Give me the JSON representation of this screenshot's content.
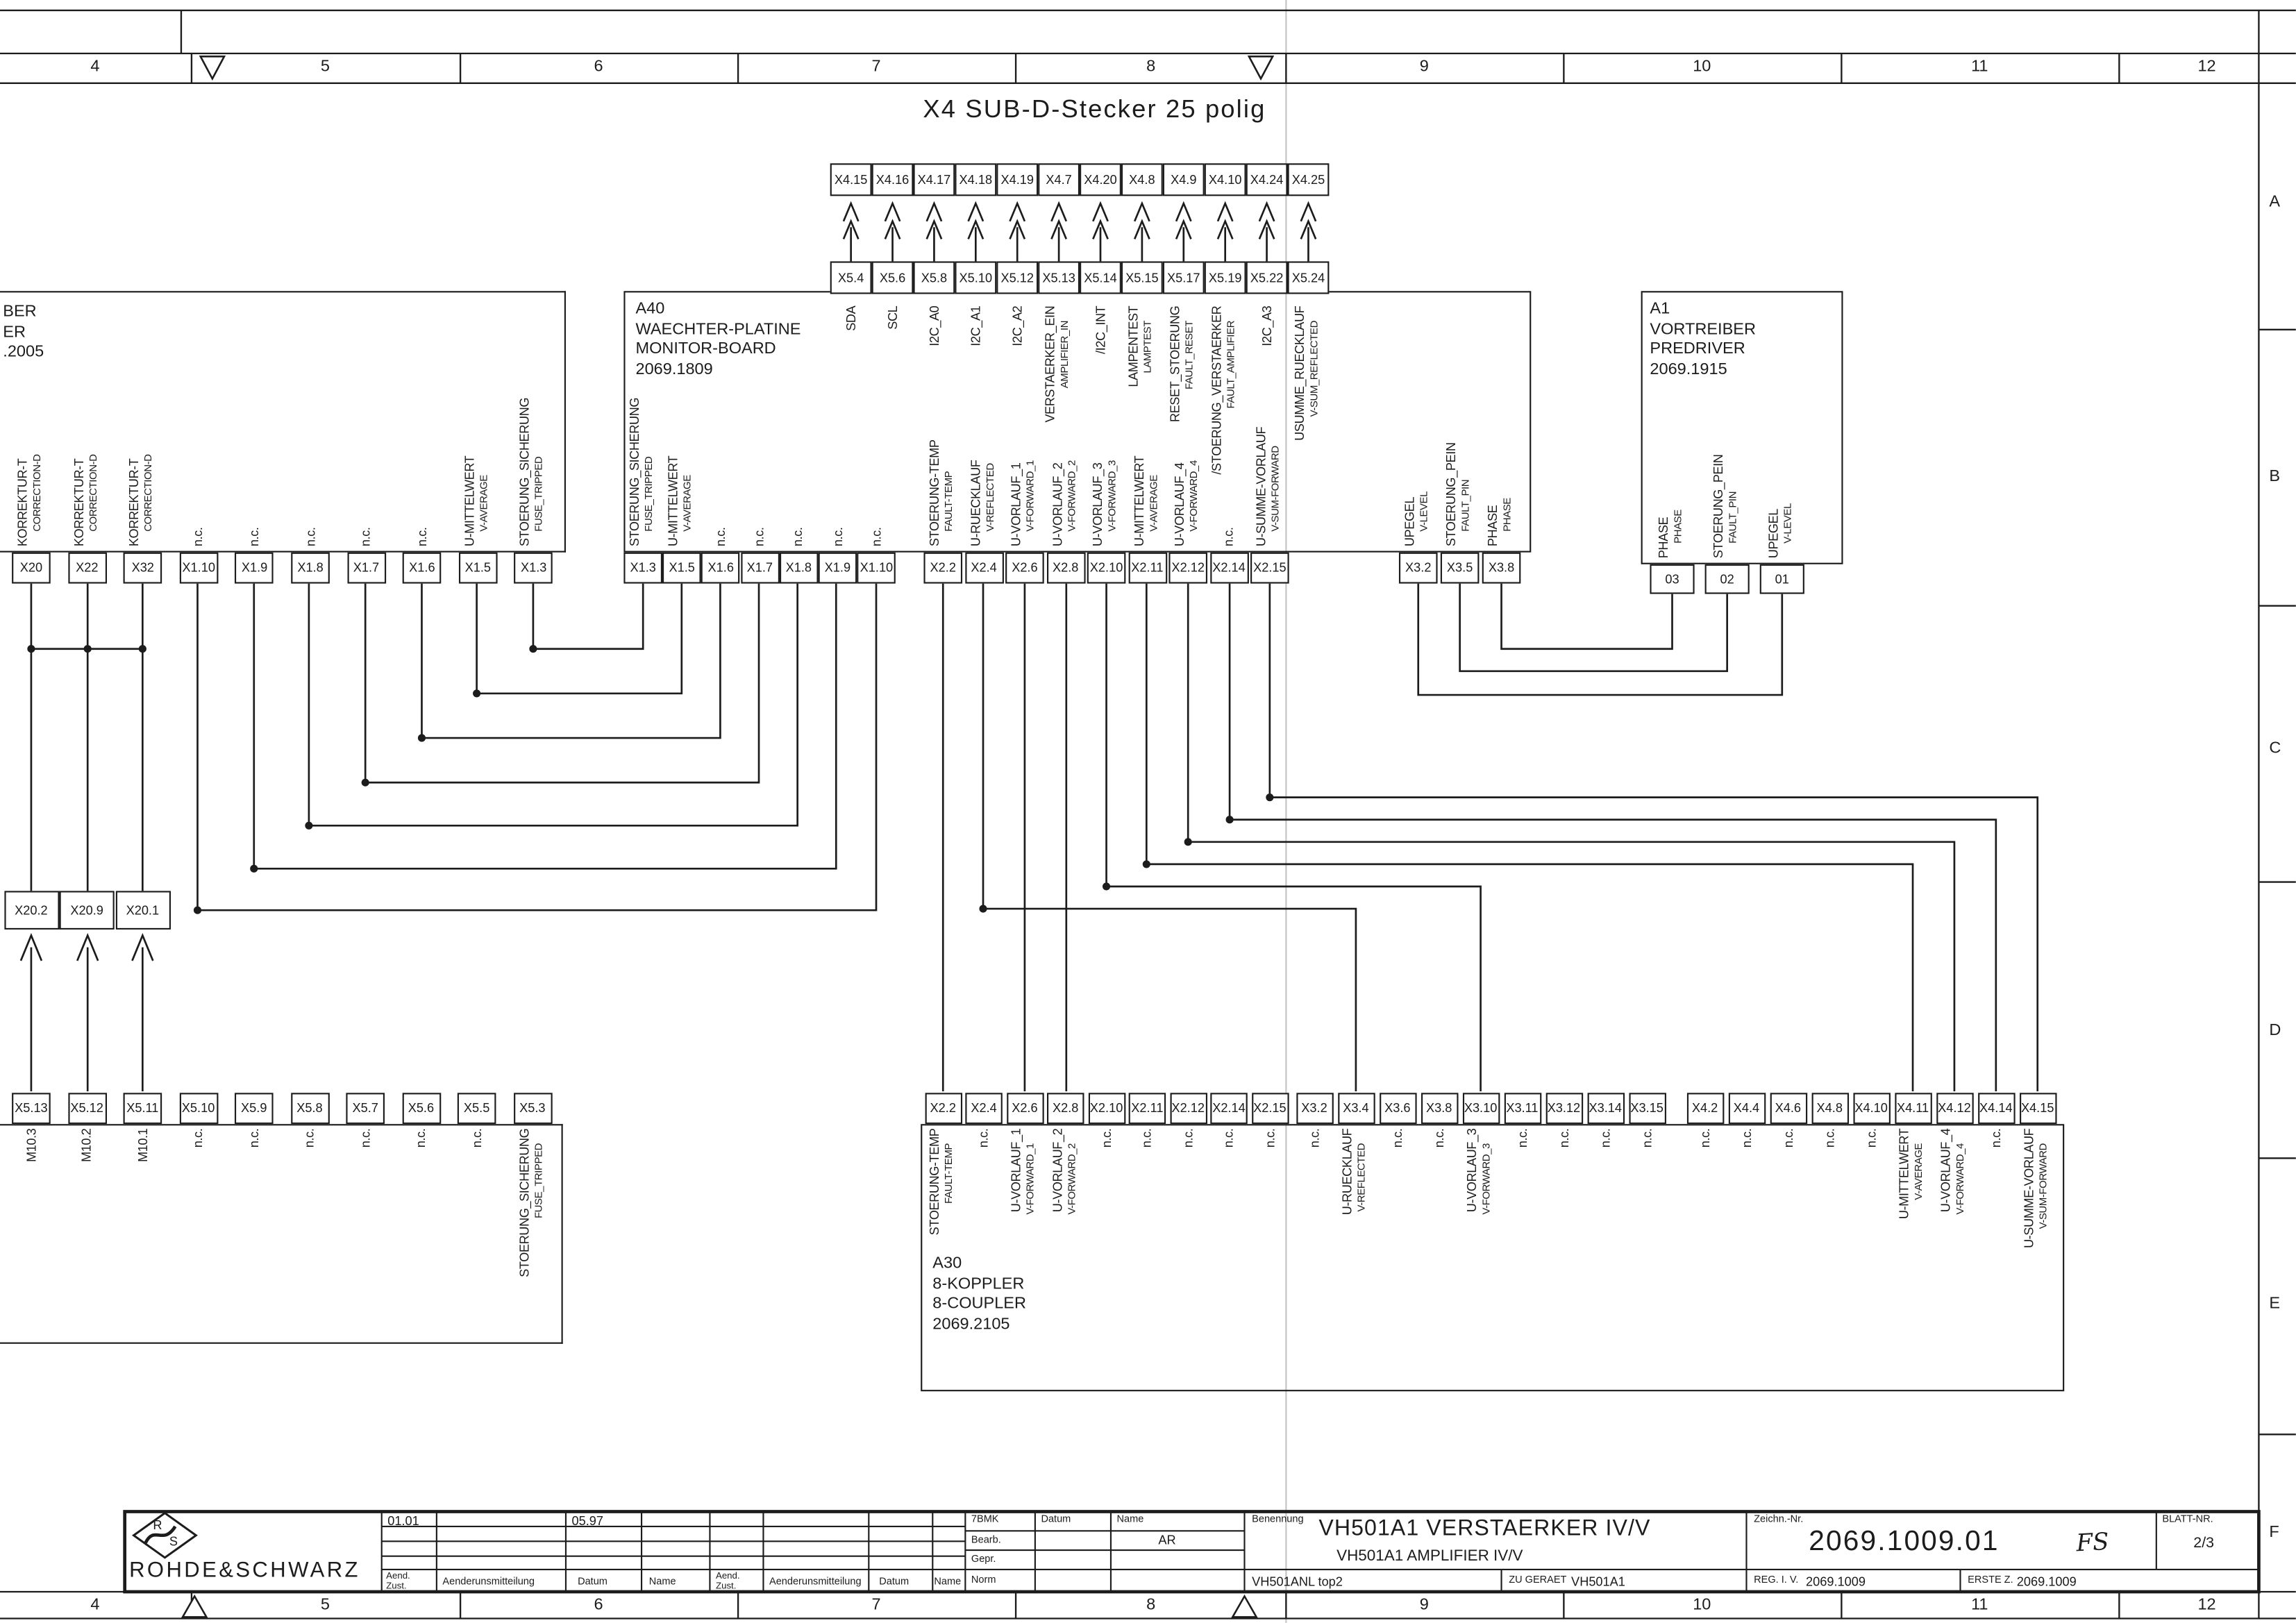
{
  "sheet": {
    "header_title": "X4 SUB-D-Stecker 25 polig",
    "border": {
      "columns": [
        "4",
        "5",
        "6",
        "7",
        "8",
        "9",
        "10",
        "11",
        "12"
      ],
      "rows": [
        "A",
        "B",
        "C",
        "D",
        "E",
        "F"
      ]
    }
  },
  "x4_row": [
    "X4.15",
    "X4.16",
    "X4.17",
    "X4.18",
    "X4.19",
    "X4.7",
    "X4.20",
    "X4.8",
    "X4.9",
    "X4.10",
    "X4.24",
    "X4.25"
  ],
  "x5_row": [
    "X5.4",
    "X5.6",
    "X5.8",
    "X5.10",
    "X5.12",
    "X5.13",
    "X5.14",
    "X5.15",
    "X5.17",
    "X5.19",
    "X5.22",
    "X5.24"
  ],
  "blocks": {
    "left": {
      "title_lines": [
        "BER",
        "ER",
        ".2005"
      ],
      "pins": [
        {
          "id": "X20",
          "l1": "KORREKTUR-T",
          "l2": "CORRECTION-D"
        },
        {
          "id": "X22",
          "l1": "KORREKTUR-T",
          "l2": "CORRECTION-D"
        },
        {
          "id": "X32",
          "l1": "KORREKTUR-T",
          "l2": "CORRECTION-D"
        },
        {
          "id": "X1.10",
          "l1": "n.c."
        },
        {
          "id": "X1.9",
          "l1": "n.c."
        },
        {
          "id": "X1.8",
          "l1": "n.c."
        },
        {
          "id": "X1.7",
          "l1": "n.c."
        },
        {
          "id": "X1.6",
          "l1": "n.c."
        },
        {
          "id": "X1.5",
          "l1": "U-MITTELWERT",
          "l2": "V-AVERAGE"
        },
        {
          "id": "X1.3",
          "l1": "STOERUNG_SICHERUNG",
          "l2": "FUSE_TRIPPED"
        }
      ]
    },
    "a40": {
      "title_lines": [
        "A40",
        "WAECHTER-PLATINE",
        "MONITOR-BOARD",
        "2069.1809"
      ],
      "top_labels": [
        {
          "l1": "SDA"
        },
        {
          "l1": "SCL"
        },
        {
          "l1": "I2C_A0"
        },
        {
          "l1": "I2C_A1"
        },
        {
          "l1": "I2C_A2"
        },
        {
          "l1": "VERSTAERKER_EIN",
          "l2": "AMPLIFIER_IN"
        },
        {
          "l1": "/I2C_INT"
        },
        {
          "l1": "LAMPENTEST",
          "l2": "LAMPTEST"
        },
        {
          "l1": "RESET_STOERUNG",
          "l2": "FAULT_RESET"
        },
        {
          "l1": "/STOERUNG_VERSTAERKER",
          "l2": "FAULT_AMPLIFIER"
        },
        {
          "l1": "I2C_A3"
        },
        {
          "l1": "USUMME_RUECKLAUF",
          "l2": "V-SUM_REFLECTED"
        }
      ],
      "pins_x1": [
        {
          "id": "X1.3",
          "l1": "STOERUNG_SICHERUNG",
          "l2": "FUSE_TRIPPED"
        },
        {
          "id": "X1.5",
          "l1": "U-MITTELWERT",
          "l2": "V-AVERAGE"
        },
        {
          "id": "X1.6",
          "l1": "n.c."
        },
        {
          "id": "X1.7",
          "l1": "n.c."
        },
        {
          "id": "X1.8",
          "l1": "n.c."
        },
        {
          "id": "X1.9",
          "l1": "n.c."
        },
        {
          "id": "X1.10",
          "l1": "n.c."
        }
      ],
      "pins_x2": [
        {
          "id": "X2.2",
          "l1": "STOERUNG-TEMP",
          "l2": "FAULT-TEMP"
        },
        {
          "id": "X2.4",
          "l1": "U-RUECKLAUF",
          "l2": "V-REFLECTED"
        },
        {
          "id": "X2.6",
          "l1": "U-VORLAUF_1",
          "l2": "V-FORWARD_1"
        },
        {
          "id": "X2.8",
          "l1": "U-VORLAUF_2",
          "l2": "V-FORWARD_2"
        },
        {
          "id": "X2.10",
          "l1": "U-VORLAUF_3",
          "l2": "V-FORWARD_3"
        },
        {
          "id": "X2.11",
          "l1": "U-MITTELWERT",
          "l2": "V-AVERAGE"
        },
        {
          "id": "X2.12",
          "l1": "U-VORLAUF_4",
          "l2": "V-FORWARD_4"
        },
        {
          "id": "X2.14",
          "l1": "n.c."
        },
        {
          "id": "X2.15",
          "l1": "U-SUMME-VORLAUF",
          "l2": "V-SUM-FORWARD"
        }
      ],
      "pins_x3": [
        {
          "id": "X3.2",
          "l1": "UPEGEL",
          "l2": "V-LEVEL"
        },
        {
          "id": "X3.5",
          "l1": "STOERUNG_PEIN",
          "l2": "FAULT_PIN"
        },
        {
          "id": "X3.8",
          "l1": "PHASE",
          "l2": "PHASE"
        }
      ]
    },
    "a1": {
      "title_lines": [
        "A1",
        "VORTREIBER",
        "PREDRIVER",
        "2069.1915"
      ],
      "pins": [
        {
          "id": "03",
          "l1": "PHASE",
          "l2": "PHASE"
        },
        {
          "id": "02",
          "l1": "STOERUNG_PEIN",
          "l2": "FAULT_PIN"
        },
        {
          "id": "01",
          "l1": "UPEGEL",
          "l2": "V-LEVEL"
        }
      ]
    },
    "x20_boxes": [
      {
        "id": "X20.2"
      },
      {
        "id": "X20.9"
      },
      {
        "id": "X20.1"
      }
    ],
    "lower_left": {
      "pins": [
        {
          "id": "X5.13",
          "l1": "M10.3"
        },
        {
          "id": "X5.12",
          "l1": "M10.2"
        },
        {
          "id": "X5.11",
          "l1": "M10.1"
        },
        {
          "id": "X5.10",
          "l1": "n.c."
        },
        {
          "id": "X5.9",
          "l1": "n.c."
        },
        {
          "id": "X5.8",
          "l1": "n.c."
        },
        {
          "id": "X5.7",
          "l1": "n.c."
        },
        {
          "id": "X5.6",
          "l1": "n.c."
        },
        {
          "id": "X5.5",
          "l1": "n.c."
        },
        {
          "id": "X5.3",
          "l1": "STOERUNG_SICHERUNG",
          "l2": "FUSE_TRIPPED"
        }
      ]
    },
    "a30": {
      "title_lines": [
        "A30",
        "8-KOPPLER",
        "8-COUPLER",
        "2069.2105"
      ],
      "pins_x2": [
        {
          "id": "X2.2",
          "l1": "STOERUNG-TEMP",
          "l2": "FAULT-TEMP"
        },
        {
          "id": "X2.4",
          "l1": "n.c."
        },
        {
          "id": "X2.6",
          "l1": "U-VORLAUF_1",
          "l2": "V-FORWARD_1"
        },
        {
          "id": "X2.8",
          "l1": "U-VORLAUF_2",
          "l2": "V-FORWARD_2"
        },
        {
          "id": "X2.10",
          "l1": "n.c."
        },
        {
          "id": "X2.11",
          "l1": "n.c."
        },
        {
          "id": "X2.12",
          "l1": "n.c."
        },
        {
          "id": "X2.14",
          "l1": "n.c."
        },
        {
          "id": "X2.15",
          "l1": "n.c."
        }
      ],
      "pins_x3": [
        {
          "id": "X3.2",
          "l1": "n.c."
        },
        {
          "id": "X3.4",
          "l1": "U-RUECKLAUF",
          "l2": "V-REFLECTED"
        },
        {
          "id": "X3.6",
          "l1": "n.c."
        },
        {
          "id": "X3.8",
          "l1": "n.c."
        },
        {
          "id": "X3.10",
          "l1": "U-VORLAUF_3",
          "l2": "V-FORWARD_3"
        },
        {
          "id": "X3.11",
          "l1": "n.c."
        },
        {
          "id": "X3.12",
          "l1": "n.c."
        },
        {
          "id": "X3.14",
          "l1": "n.c."
        },
        {
          "id": "X3.15",
          "l1": "n.c."
        }
      ],
      "pins_x4": [
        {
          "id": "X4.2",
          "l1": "n.c."
        },
        {
          "id": "X4.4",
          "l1": "n.c."
        },
        {
          "id": "X4.6",
          "l1": "n.c."
        },
        {
          "id": "X4.8",
          "l1": "n.c."
        },
        {
          "id": "X4.10",
          "l1": "n.c."
        },
        {
          "id": "X4.11",
          "l1": "U-MITTELWERT",
          "l2": "V-AVERAGE"
        },
        {
          "id": "X4.12",
          "l1": "U-VORLAUF_4",
          "l2": "V-FORWARD_4"
        },
        {
          "id": "X4.14",
          "l1": "n.c."
        },
        {
          "id": "X4.15",
          "l1": "U-SUMME-VORLAUF",
          "l2": "V-SUM-FORWARD"
        }
      ]
    }
  },
  "title_block": {
    "company": "ROHDE&SCHWARZ",
    "logo": {
      "r": "R",
      "s": "S"
    },
    "rev": {
      "zust1": "01.01",
      "datum1": "05.97"
    },
    "rev_headers": {
      "aend1": "Aend.",
      "aend2": "Zust.",
      "mitteilung": "Aenderunsmitteilung",
      "datum": "Datum",
      "name": "Name"
    },
    "approval": {
      "code": "7BMK",
      "datum": "Datum",
      "name": "Name",
      "row1": "Bearb.",
      "row2": "Gepr.",
      "row3": "Norm",
      "bearb_name": "AR"
    },
    "benennung": {
      "label": "Benennung",
      "title": "VH501A1 VERSTAERKER IV/V",
      "subtitle": "VH501A1 AMPLIFIER IV/V",
      "doc_id": "VH501ANL top2",
      "zu_geraet_label": "ZU GERAET",
      "zu_geraet_value": "VH501A1"
    },
    "zeichn": {
      "label": "Zeichn.-Nr.",
      "number": "2069.1009.01",
      "annotation": "FS",
      "reg_label": "REG. I. V.",
      "reg_value": "2069.1009",
      "erste_label": "ERSTE Z.",
      "erste_value": "2069.1009"
    },
    "blatt": {
      "label": "BLATT-NR.",
      "value": "2/3"
    }
  }
}
